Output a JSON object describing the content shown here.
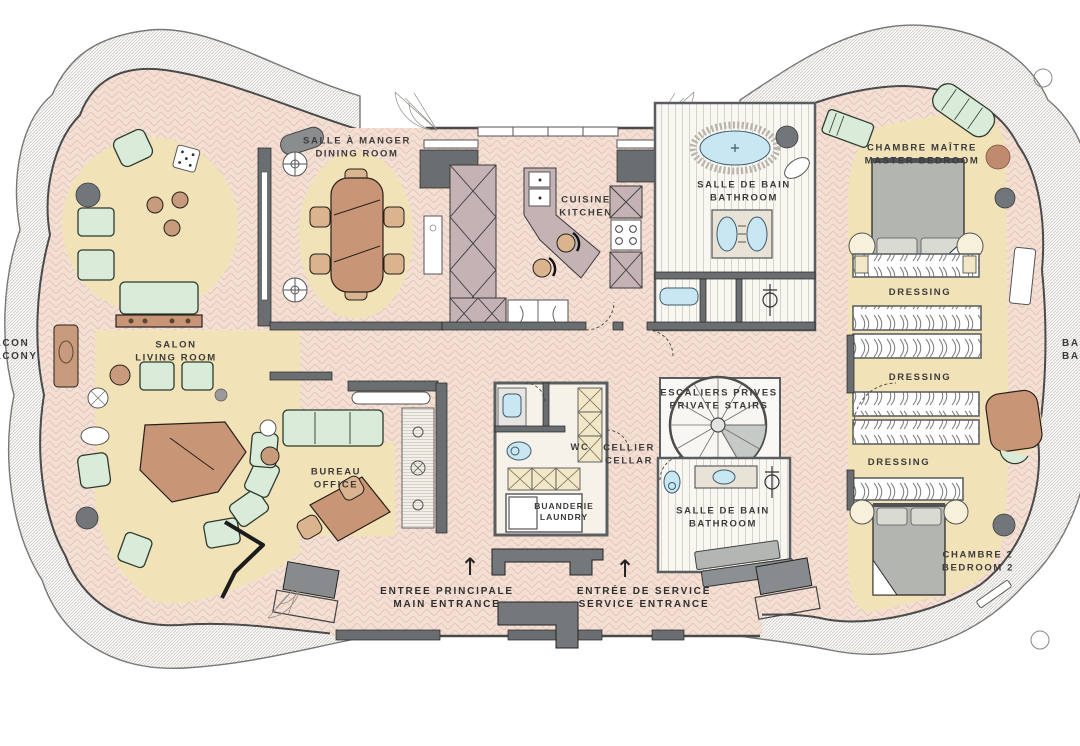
{
  "plan_title": "Penthouse floor plan",
  "labels": {
    "dining": {
      "fr": "SALLE À MANGER",
      "en": "DINING ROOM"
    },
    "kitchen": {
      "fr": "CUISINE",
      "en": "KITCHEN"
    },
    "master_bathroom": {
      "fr": "SALLE DE BAIN",
      "en": "BATHROOM"
    },
    "master_bedroom": {
      "fr": "CHAMBRE MAÎTRE",
      "en": "MASTER BEDROOM"
    },
    "dressing_1": {
      "fr": "DRESSING"
    },
    "dressing_2": {
      "fr": "DRESSING"
    },
    "dressing_3": {
      "fr": "DRESSING"
    },
    "salon": {
      "fr": "SALON",
      "en": "LIVING ROOM"
    },
    "bureau": {
      "fr": "BUREAU",
      "en": "OFFICE"
    },
    "wc": {
      "fr": "WC"
    },
    "cellier": {
      "fr": "CELLIER",
      "en": "CELLAR"
    },
    "buanderie": {
      "fr": "BUANDERIE",
      "en": "LAUNDRY"
    },
    "private_stairs": {
      "fr": "ESCALIERS PRIVES",
      "en": "PRIVATE STAIRS"
    },
    "bathroom_2": {
      "fr": "SALLE DE BAIN",
      "en": "BATHROOM"
    },
    "bedroom_2": {
      "fr": "CHAMBRE 2",
      "en": "BEDROOM 2"
    },
    "main_entrance": {
      "fr": "ENTREE PRINCIPALE",
      "en": "MAIN ENTRANCE"
    },
    "service_entrance": {
      "fr": "ENTRÉE DE SERVICE",
      "en": "SERVICE ENTRANCE"
    },
    "balcony_left": {
      "fr": "BALCON",
      "en": "BALCONY"
    },
    "balcony_right": {
      "fr": "BALCON",
      "en": "BALCONY"
    }
  },
  "symbols": {
    "entrance_arrow": "↑"
  },
  "colors": {
    "floor": "#f4dfd5",
    "floor_hatch": "#e2c3b2",
    "rug": "#f2e2b8",
    "wall": "#6b6e71",
    "furniture_green": "#d9ecda",
    "furniture_wood": "#c89677",
    "cabinet_mauve": "#c4b2b4",
    "fixture_blue": "#c9e7f3",
    "label_ink": "#3b3b3b",
    "balcony_hatch": "#b5b0a8",
    "bed_gray": "#b3b6b0",
    "shelf_cream": "#f2e8c8"
  }
}
